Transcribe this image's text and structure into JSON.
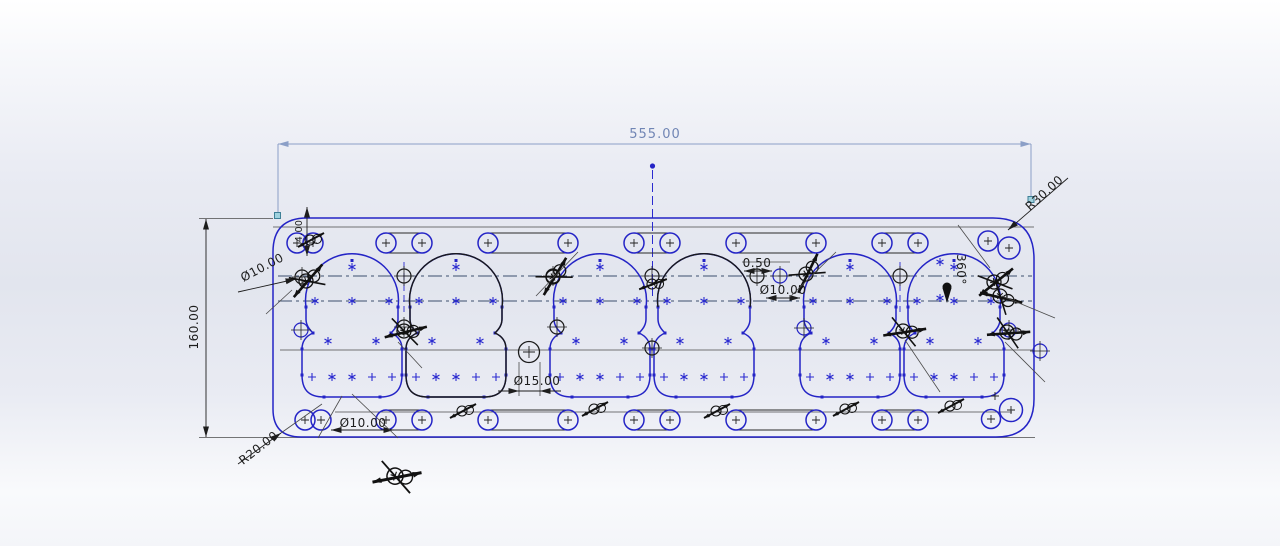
{
  "dimensions": {
    "overall_width": "555.00",
    "overall_height": "160.00",
    "radius_top_right": "R30.00",
    "radius_bottom_left": "R20.00",
    "dia_hole_left": "Ø10.00",
    "offset_mid": "0.50",
    "dia_hole_mid": "Ø10.00",
    "dia_hole_center": "Ø15.00",
    "dia_hole_bottom": "Ø10.00",
    "angle_full": "360°",
    "len_corner": "4.00"
  },
  "colors": {
    "sketch_blue": "#2424c6",
    "annotation_black": "#1a1a1a",
    "centerline_gray": "#3c4f6e",
    "selected_dimension": "#7186b5",
    "selection_handle": "#7ab7c9"
  }
}
